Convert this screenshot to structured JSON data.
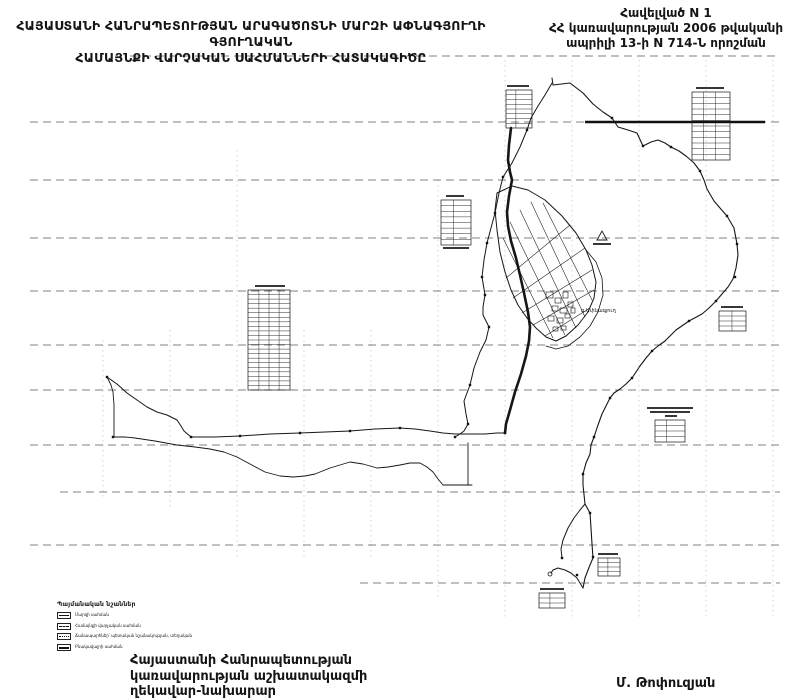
{
  "header": {
    "line1": "ՀԱՅԱՍՏԱՆԻ ՀԱՆՐԱՊԵՏՈՒԹՅԱՆ ԱՐԱԳԱԾՈՏՆԻ ՄԱՐԶԻ ԱՓՆԱԳՅՈՒՂԻ ԳՅՈՒՂԱԿԱՆ",
    "line2": "ՀԱՄԱՅՆՔԻ ՎԱՐՉԱԿԱՆ ՍԱՀՄԱՆՆԵՐԻ ՀԱՏԱԿԱԳԻԾԸ"
  },
  "appendix": {
    "line1": "Հավելված N 1",
    "line2": "ՀՀ կառավարության 2006 թվականի",
    "line3": "ապրիլի 13-ի N 714-Ն որոշման"
  },
  "legend": {
    "title": "Պայմանական նշաններ",
    "items": [
      {
        "label": "Մարզի սահման"
      },
      {
        "label": "Համայնքի վարչական սահման"
      },
      {
        "label": "Ճանապարհներ՝ պետական նշանակության, տեղական"
      },
      {
        "label": "Բնակավայրի սահման"
      }
    ]
  },
  "footer": {
    "line1": "Հայաստանի Հանրապետության",
    "line2": "կառավարության աշխատակազմի",
    "line3": "ղեկավար-նախարար",
    "signer": "Մ. Թոփուզյան"
  },
  "map": {
    "village_label": "գ.Ափնագյուղ",
    "colors": {
      "ink": "#161616",
      "grid": "#2e2e2e",
      "paper": "#ffffff"
    },
    "grid_h": [
      {
        "y": 56,
        "x1": 130,
        "x2": 780
      },
      {
        "y": 122,
        "x1": 30,
        "x2": 780
      },
      {
        "y": 180,
        "x1": 30,
        "x2": 780
      },
      {
        "y": 238,
        "x1": 30,
        "x2": 780
      },
      {
        "y": 291,
        "x1": 30,
        "x2": 780
      },
      {
        "y": 345,
        "x1": 30,
        "x2": 780
      },
      {
        "y": 390,
        "x1": 30,
        "x2": 780
      },
      {
        "y": 445,
        "x1": 30,
        "x2": 780
      },
      {
        "y": 492,
        "x1": 60,
        "x2": 780
      },
      {
        "y": 545,
        "x1": 30,
        "x2": 780
      },
      {
        "y": 583,
        "x1": 360,
        "x2": 780
      }
    ],
    "grid_v": [
      {
        "x": 103,
        "y1": 340,
        "y2": 500
      },
      {
        "x": 170,
        "y1": 330,
        "y2": 510
      },
      {
        "x": 237,
        "y1": 150,
        "y2": 560
      },
      {
        "x": 304,
        "y1": 330,
        "y2": 560
      },
      {
        "x": 371,
        "y1": 330,
        "y2": 560
      },
      {
        "x": 438,
        "y1": 180,
        "y2": 600
      },
      {
        "x": 505,
        "y1": 60,
        "y2": 620
      },
      {
        "x": 572,
        "y1": 60,
        "y2": 620
      },
      {
        "x": 639,
        "y1": 60,
        "y2": 620
      },
      {
        "x": 706,
        "y1": 60,
        "y2": 620
      },
      {
        "x": 773,
        "y1": 60,
        "y2": 620
      }
    ],
    "bold_segments": [
      {
        "y": 122,
        "x1": 585,
        "x2": 765
      }
    ],
    "paths": [
      {
        "name": "north-tip-line",
        "w": 1,
        "d": "M552 78 L553 85"
      },
      {
        "name": "east-boundary",
        "w": 1.1,
        "d": "M553 85 L570 83 L583 93 L593 104 L603 112 L612 118 L618 127 L628 130 L637 133 L643 146 L651 142 L658 140 L665 143 L671 147 L679 151 L686 156 L694 163 L700 171 L704 180 L707 189 L714 201 L720 208 L727 216 L734 228 L737 244 L738 255 L736 268 L733 279 L728 287 L722 294 L716 301 L709 308 L702 314 L689 321 L676 330 L665 341 L658 346 L652 351 L646 358 L640 366 L632 378 L626 384 L620 389 L614 393 L610 398 L606 406 L602 414 L598 425 L594 437 L591 445 L590 454 L586 463 L583 474 L583 485 L585 504 L590 513 L591 528 L592 544 L593 558 L590 565 L588 570 L585 578 L583 588"
      },
      {
        "name": "south-outlet",
        "w": 1,
        "d": "M583 588 L577 578 L571 573 L565 570 L558 568 L553 570 L551 573 M562 558 L561 549 L563 540 L568 528 L574 518 L580 510 L585 504"
      },
      {
        "name": "west-river",
        "w": 1,
        "d": "M552 83 L545 95 L538 106 L531 118 L527 130 L520 147 L512 163 L503 177 L499 193 L495 213 L491 228 L487 243 L484 260 L482 277 L485 295 L483 307 L483 315 L489 327 L486 340 L480 352 L474 368 L470 385 L464 401 L466 414 L468 424 L464 431 L460 434 L455 437"
      },
      {
        "name": "tail-top-boundary",
        "w": 1,
        "d": "M107 377 L117 384 L127 393 L137 400 L147 407 L157 412 L167 415 L177 420 L181 426 L184 431 L191 437 L215 437 L240 436 L270 434 L300 433 L325 432 L350 431 L375 429 L400 428 L415 429 L430 431 L443 433 L455 434 L470 434 L485 434 L497 433 L505 433"
      },
      {
        "name": "tail-river",
        "w": 0.9,
        "d": "M107 377 L111 385 L113 392 L114 405 L114 420 L114 437 L125 437 L135 438 L155 441 L177 445 L195 447 L210 449 L224 452 L237 457 L250 464 L265 472 L280 476 L293 477 L305 476 L315 474 L330 468 L350 462 L363 464 L377 468 L388 467 L400 465 L410 463 L420 463 L427 467 L433 472 L438 479 L443 485 L455 485 L465 485 L472 485 M468 443 L468 485"
      },
      {
        "name": "main-road-thick",
        "w": 2.6,
        "d": "M511 128 L509 145 L508 160 L510 172 L512 180 L509 196 L507 212 L508 226 L511 241 L516 258 L520 275 L524 293 L528 312 L530 327 L529 341 L526 356 L521 374 L515 392 L510 410 L506 424 L505 433"
      },
      {
        "name": "settlement-outline",
        "w": 1,
        "d": "M497 193 L512 186 L528 190 L545 200 L562 216 L576 233 L586 250 L592 265 L596 282 L594 298 L588 312 L578 325 L566 336 L556 341 L546 337 L536 328 L527 318 L518 305 L511 290 L505 272 L500 252 L497 230 L495 210 Z"
      },
      {
        "name": "settlement-halo",
        "w": 0.8,
        "d": "M586 250 L596 262 L602 278 L603 295 L598 312 L590 326 L580 337 L568 346 L556 349 L546 346"
      },
      {
        "name": "settlement-street-mesh",
        "w": 0.55,
        "d": "M503 238 L553 338 M510 222 L565 335 M520 210 L576 328 M531 202 L585 317 M543 203 L592 300 M506 278 L570 225 M513 298 L585 248 M522 313 L592 270 M533 325 L594 290 M545 336 L590 308"
      }
    ],
    "markers": [
      [
        612,
        118
      ],
      [
        643,
        146
      ],
      [
        671,
        147
      ],
      [
        700,
        171
      ],
      [
        727,
        216
      ],
      [
        737,
        244
      ],
      [
        735,
        277
      ],
      [
        716,
        301
      ],
      [
        689,
        321
      ],
      [
        652,
        351
      ],
      [
        632,
        378
      ],
      [
        610,
        398
      ],
      [
        594,
        437
      ],
      [
        583,
        474
      ],
      [
        590,
        513
      ],
      [
        593,
        557
      ],
      [
        527,
        130
      ],
      [
        503,
        177
      ],
      [
        495,
        213
      ],
      [
        487,
        243
      ],
      [
        482,
        277
      ],
      [
        485,
        295
      ],
      [
        489,
        327
      ],
      [
        470,
        385
      ],
      [
        468,
        424
      ],
      [
        107,
        377
      ],
      [
        113,
        437
      ],
      [
        191,
        437
      ],
      [
        240,
        436
      ],
      [
        300,
        433
      ],
      [
        350,
        431
      ],
      [
        400,
        428
      ],
      [
        455,
        437
      ],
      [
        505,
        433
      ],
      [
        562,
        558
      ],
      [
        577,
        575
      ]
    ],
    "circle_markers": [
      {
        "cx": 550,
        "cy": 574,
        "r": 2
      }
    ],
    "parcel_rects": [
      [
        546,
        292,
        7,
        6
      ],
      [
        555,
        298,
        6,
        5
      ],
      [
        563,
        292,
        5,
        6
      ],
      [
        552,
        306,
        6,
        5
      ],
      [
        560,
        308,
        7,
        5
      ],
      [
        568,
        302,
        5,
        5
      ],
      [
        548,
        316,
        6,
        5
      ],
      [
        557,
        318,
        6,
        5
      ],
      [
        565,
        314,
        5,
        4
      ],
      [
        571,
        308,
        4,
        5
      ],
      [
        553,
        327,
        5,
        4
      ],
      [
        561,
        326,
        5,
        4
      ]
    ],
    "tables": [
      {
        "name": "coord-table-north",
        "x": 506,
        "y": 90,
        "w": 26,
        "h": 38,
        "rows": 8,
        "cols": [
          0.38
        ],
        "bars": [
          [
            1,
            -5,
            22
          ]
        ]
      },
      {
        "name": "coord-table-northeast",
        "x": 692,
        "y": 92,
        "w": 38,
        "h": 68,
        "rows": 12,
        "cols": [
          0.3,
          0.62
        ],
        "bars": [
          [
            4,
            -5,
            28
          ]
        ]
      },
      {
        "name": "coord-table-center",
        "x": 441,
        "y": 200,
        "w": 30,
        "h": 45,
        "rows": 8,
        "cols": [
          0.42
        ],
        "bars": [
          [
            5,
            -5,
            18
          ],
          [
            2,
            47,
            26
          ]
        ]
      },
      {
        "name": "coord-table-west",
        "x": 248,
        "y": 290,
        "w": 42,
        "h": 100,
        "rows": 22,
        "cols": [
          0.26,
          0.5,
          0.74
        ],
        "bars": [
          [
            7,
            -5,
            30
          ]
        ]
      },
      {
        "name": "scale-note-block",
        "x": 655,
        "y": 420,
        "w": 30,
        "h": 22,
        "rows": 4,
        "cols": [
          0.38
        ],
        "bars": [
          [
            -8,
            -13,
            46
          ],
          [
            -5,
            -9,
            40
          ],
          [
            10,
            -5,
            12
          ]
        ]
      },
      {
        "name": "coord-table-east",
        "x": 719,
        "y": 311,
        "w": 27,
        "h": 20,
        "rows": 4,
        "cols": [
          0.48
        ],
        "bars": [
          [
            2,
            -5,
            22
          ]
        ]
      },
      {
        "name": "coord-table-south",
        "x": 598,
        "y": 558,
        "w": 22,
        "h": 18,
        "rows": 4,
        "cols": [
          0.45
        ],
        "bars": [
          [
            0,
            -5,
            20
          ]
        ]
      },
      {
        "name": "coord-table-bottom",
        "x": 539,
        "y": 593,
        "w": 26,
        "h": 15,
        "rows": 3,
        "cols": [
          0.42
        ],
        "bars": [
          [
            1,
            -5,
            24
          ]
        ]
      }
    ],
    "triangle": {
      "points": "597,240 602,231 607,240",
      "bar": [
        593,
        243,
        18,
        2
      ]
    },
    "village_label_pos": {
      "x": 581,
      "y": 312
    }
  }
}
